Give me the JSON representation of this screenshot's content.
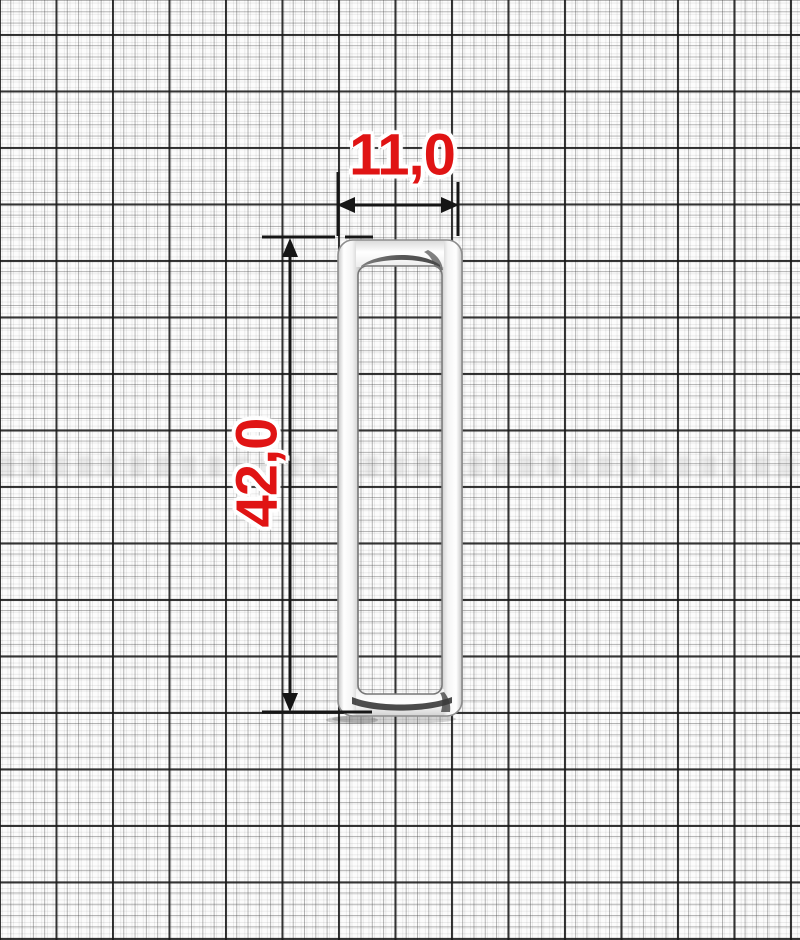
{
  "drawing": {
    "subject": "rectangular metal frame buckle on millimeter graph paper",
    "width_dimension": {
      "label": "11,0"
    },
    "height_dimension": {
      "label": "42,0"
    },
    "icons": {
      "width_arrows": "double-headed-horizontal-arrow",
      "height_arrows": "double-headed-vertical-arrow"
    },
    "colors": {
      "dimension_text_red": "#e01414",
      "dimension_line_black": "#161616",
      "paper_white": "#fcfcfc",
      "metal_silver": "#f4f4f4"
    }
  }
}
